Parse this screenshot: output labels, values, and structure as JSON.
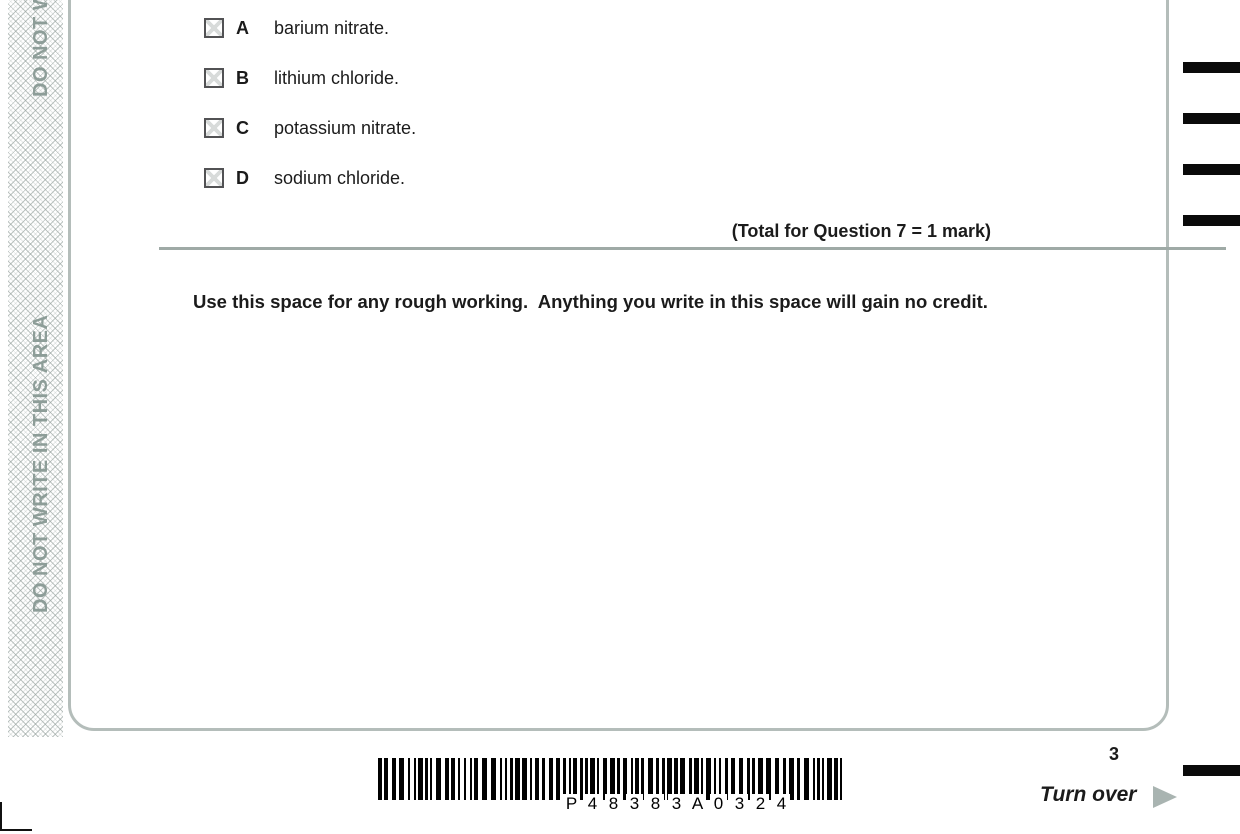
{
  "sidebar": {
    "warning_text": "DO NOT WRITE IN THIS AREA"
  },
  "question": {
    "number": "7",
    "text": "The metal salt which gives a red colour in a flame test is",
    "options": [
      {
        "letter": "A",
        "text": "barium nitrate."
      },
      {
        "letter": "B",
        "text": "lithium chloride."
      },
      {
        "letter": "C",
        "text": "potassium nitrate."
      },
      {
        "letter": "D",
        "text": "sodium chloride."
      }
    ],
    "total_label": "(Total for Question 7 = 1 mark)"
  },
  "rough_working_note": "Use this space for any rough working.  Anything you write in this space will gain no credit.",
  "footer": {
    "page_number": "3",
    "turn_over_label": "Turn over",
    "barcode_text": "P 4 8 3 8 3 A 0 3 2 4"
  },
  "colors": {
    "warning_sage": "#8d9d98",
    "frame_border": "#b4bdba",
    "rule_gray": "#9faaa6",
    "text_black": "#1b1b1b"
  }
}
